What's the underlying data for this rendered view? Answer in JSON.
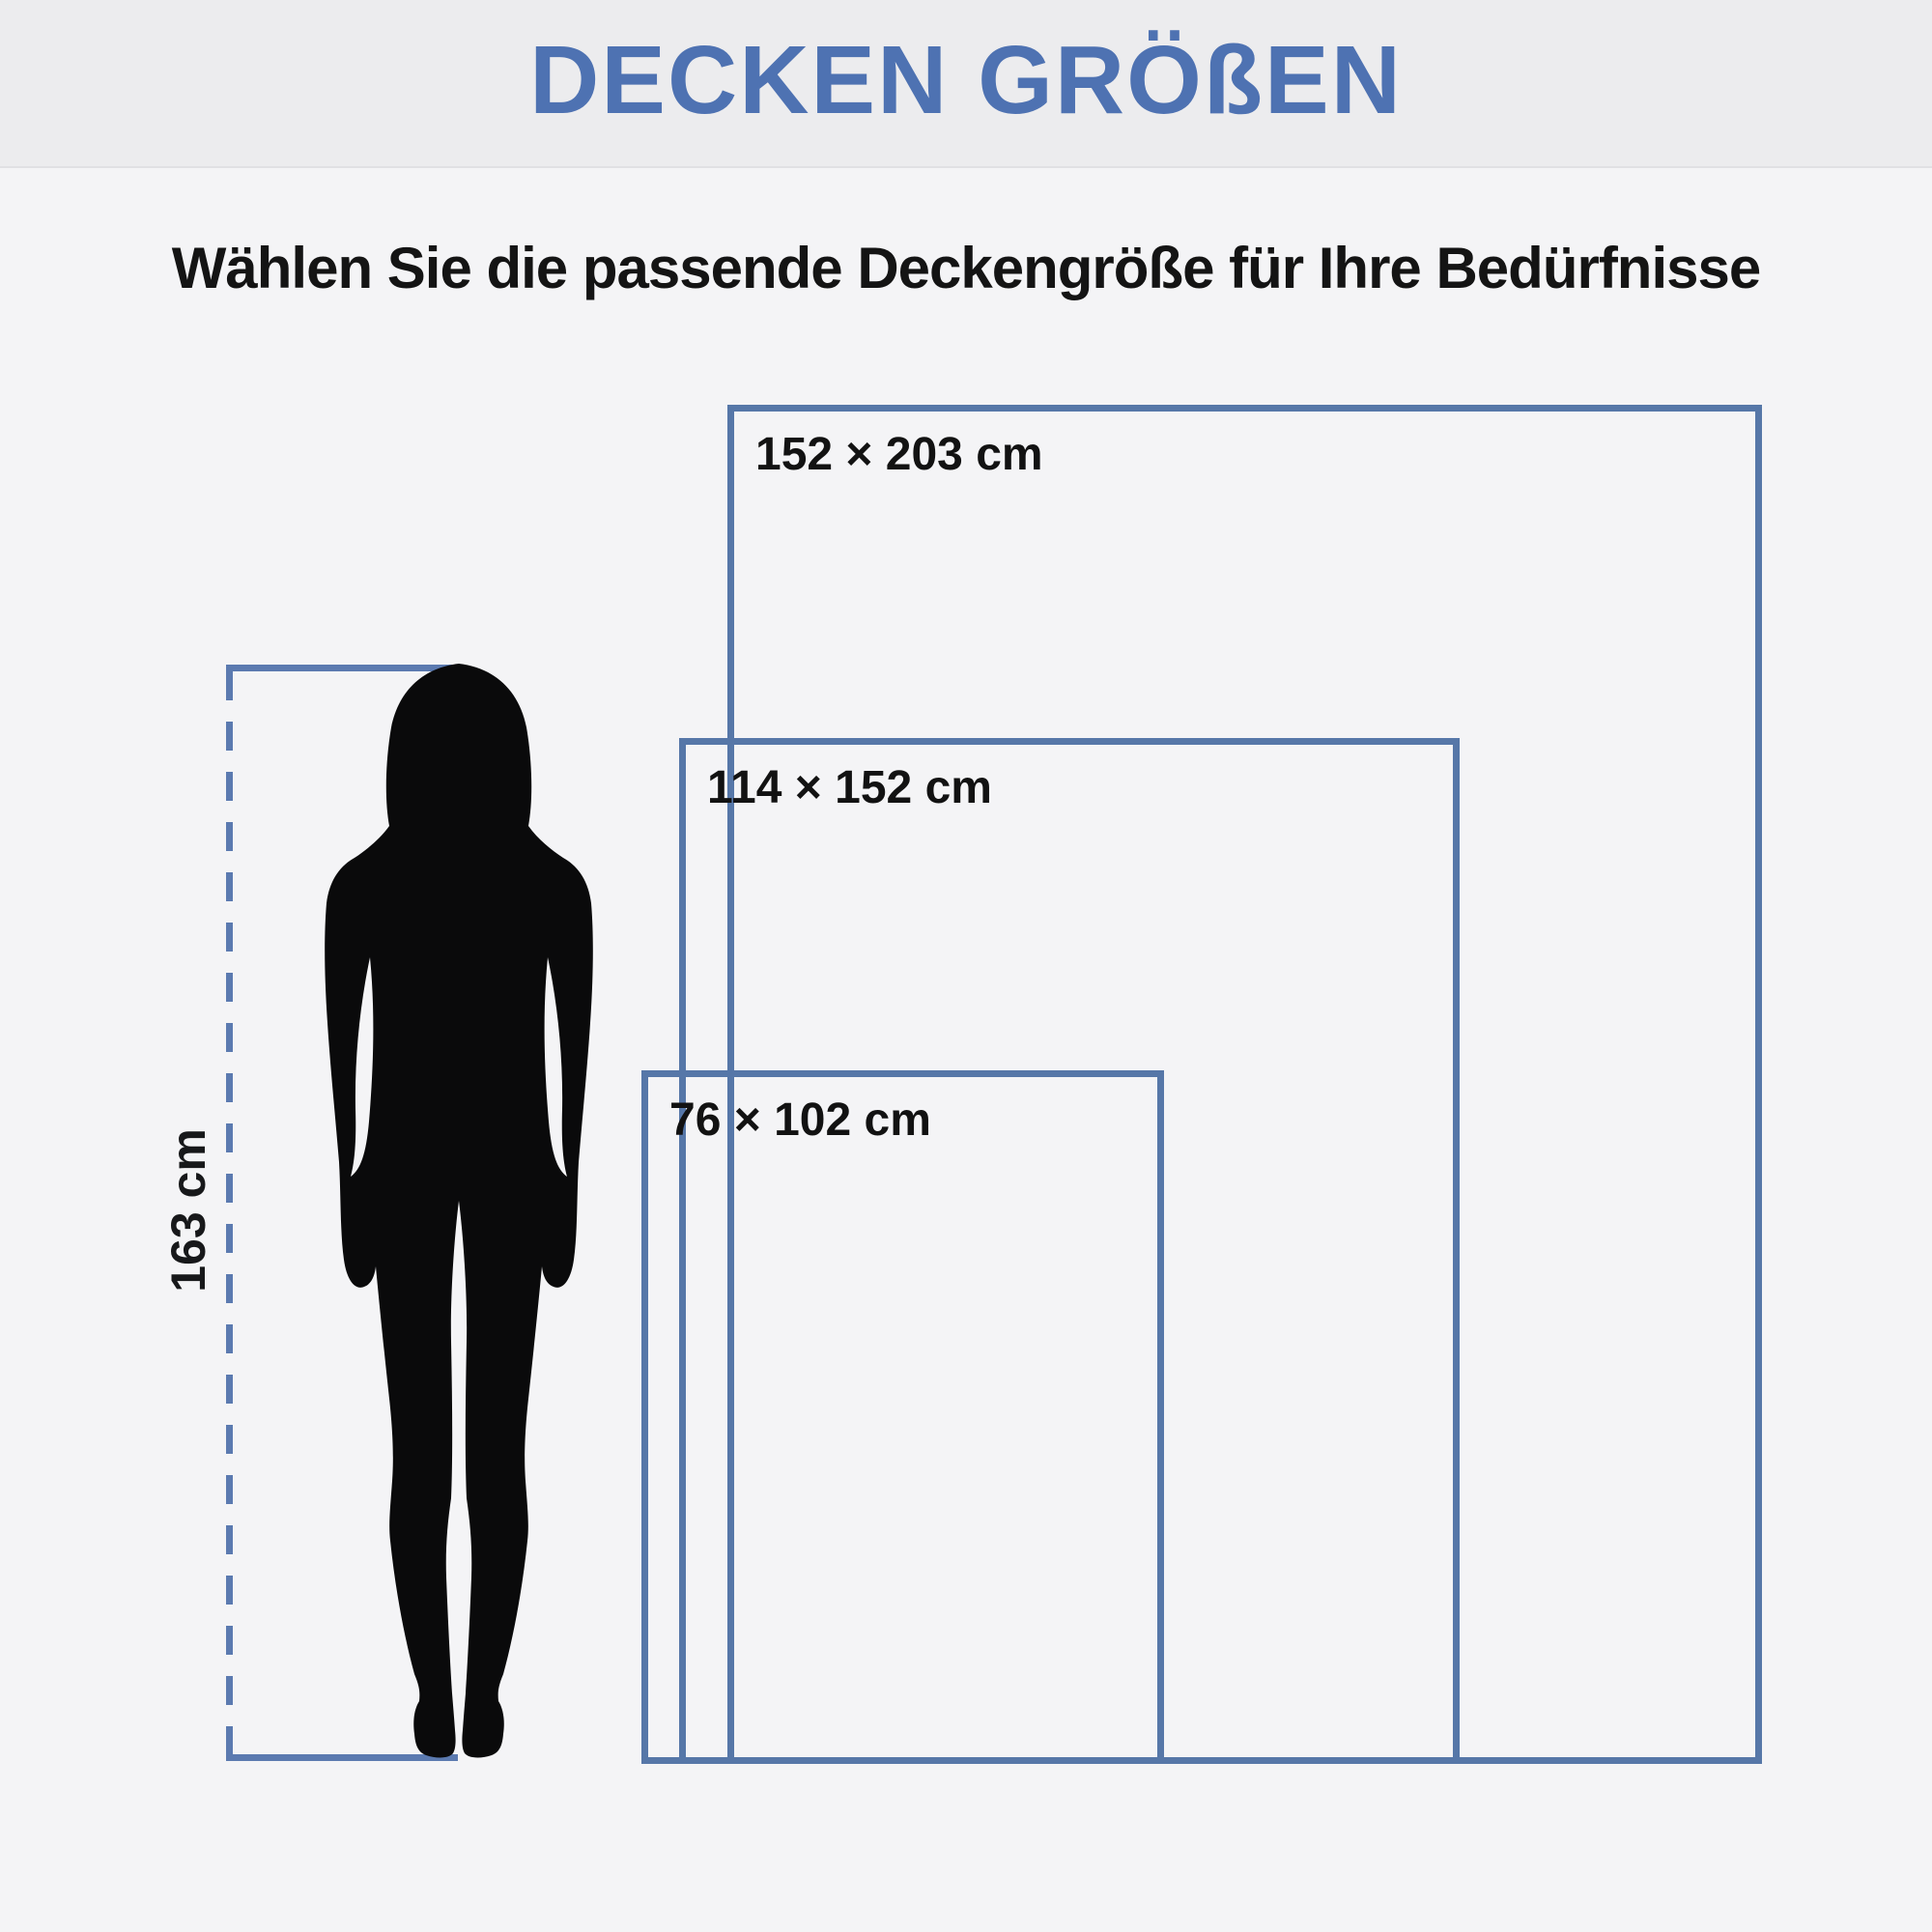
{
  "header": {
    "title": "DECKEN GRÖßEN"
  },
  "subtitle": "Wählen Sie die passende Deckengröße für Ihre Bedürfnisse",
  "figure": {
    "type": "woman-silhouette",
    "height_label": "163 cm",
    "height_cm": 163
  },
  "sizes": [
    {
      "label": "152 × 203 cm",
      "width_cm": 152,
      "height_cm": 203
    },
    {
      "label": "114 × 152 cm",
      "width_cm": 114,
      "height_cm": 152
    },
    {
      "label": "76 × 102 cm",
      "width_cm": 76,
      "height_cm": 102
    }
  ],
  "colors": {
    "accent_blue": "#4e72b2",
    "outline_blue": "#5677a8",
    "measure_blue": "#5b7ab0",
    "header_bg": "#ececee",
    "body_bg": "#f4f4f6",
    "text_dark": "#141414",
    "silhouette": "#0a0a0b"
  }
}
